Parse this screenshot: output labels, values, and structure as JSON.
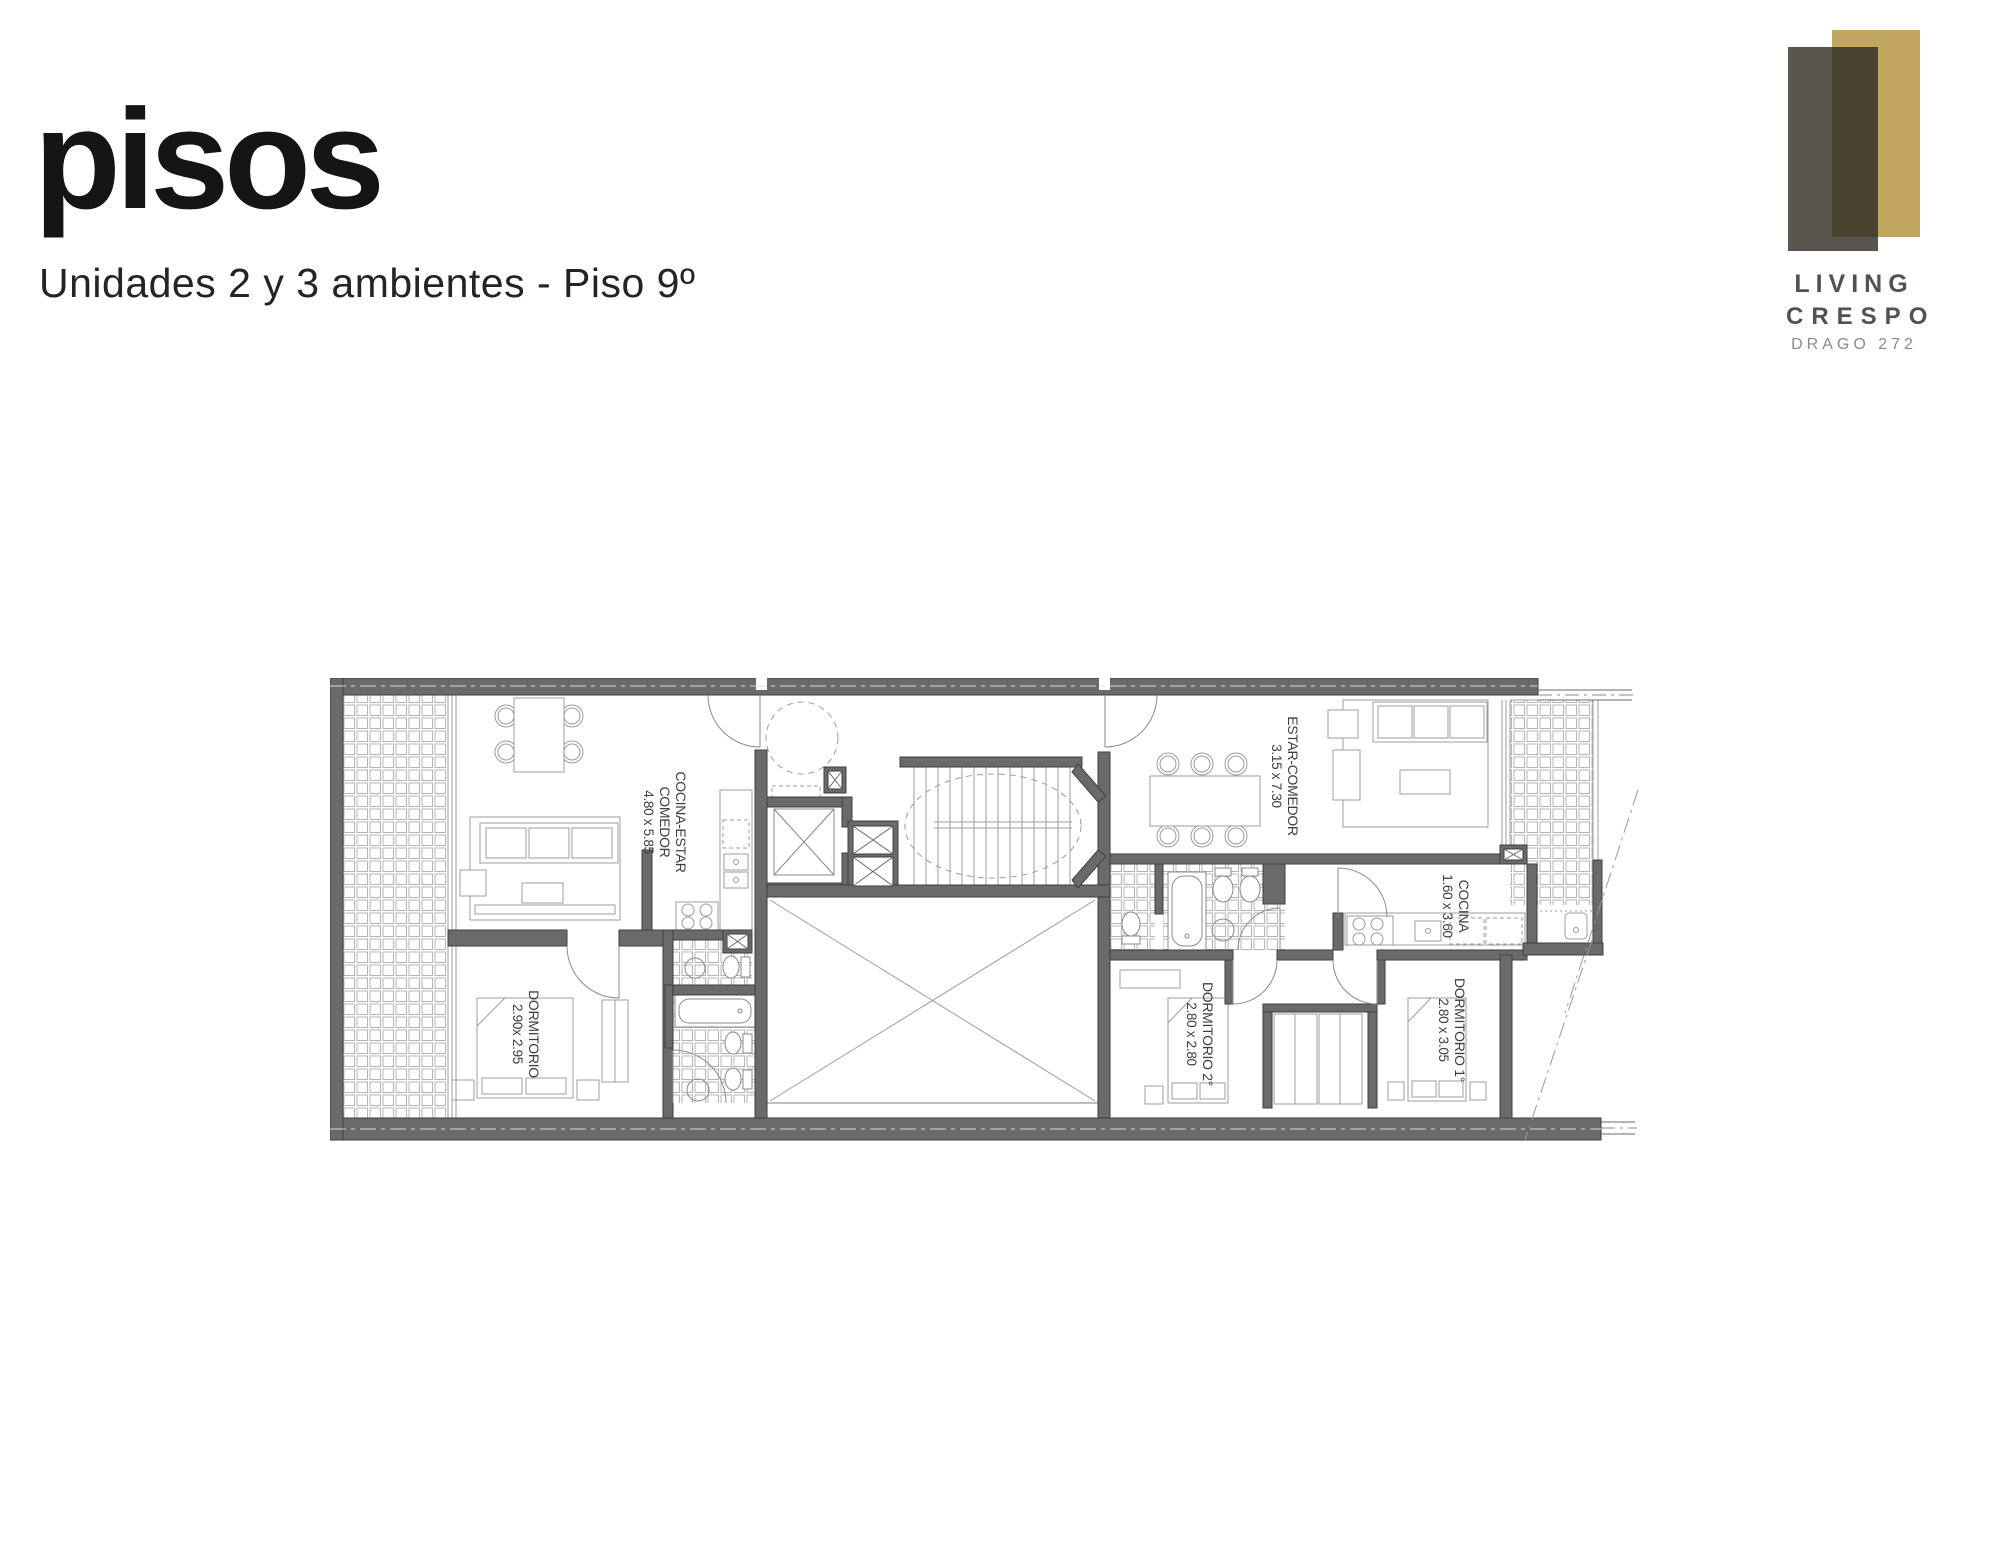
{
  "header": {
    "title": "pisos",
    "subtitle": "Unidades 2 y 3 ambientes - Piso 9º"
  },
  "logo": {
    "brand_line1": "LIVING",
    "brand_line2": "CRESPO",
    "brand_line3": "DRAGO 272",
    "colors": {
      "gray_block": "#5a564f",
      "gold_block": "#c3a660",
      "overlap_block": "#494330",
      "brand_text": "#55524d",
      "address_text": "#8d8b88"
    }
  },
  "floorplan": {
    "wall_color": "#6a6a6a",
    "fixture_line_color": "#9c9c9c",
    "label_color": "#3e3e3e",
    "rooms": {
      "living_left_1": "COCINA-ESTAR",
      "living_left_2": "COMEDOR",
      "living_left_dims": "4.80 x 5.85",
      "bedroom_left": "DORMITORIO",
      "bedroom_left_dims": "2.90x 2.95",
      "living_right": "ESTAR-COMEDOR",
      "living_right_dims": "3.15 x 7.30",
      "kitchen_right": "COCINA",
      "kitchen_right_dims": "1.60 x 3.60",
      "bedroom2_right": "DORMITORIO 2°",
      "bedroom2_right_dims": "2.80 x 2.80",
      "bedroom1_right": "DORMITORIO 1°",
      "bedroom1_right_dims": "2.80 x 3.05"
    }
  }
}
